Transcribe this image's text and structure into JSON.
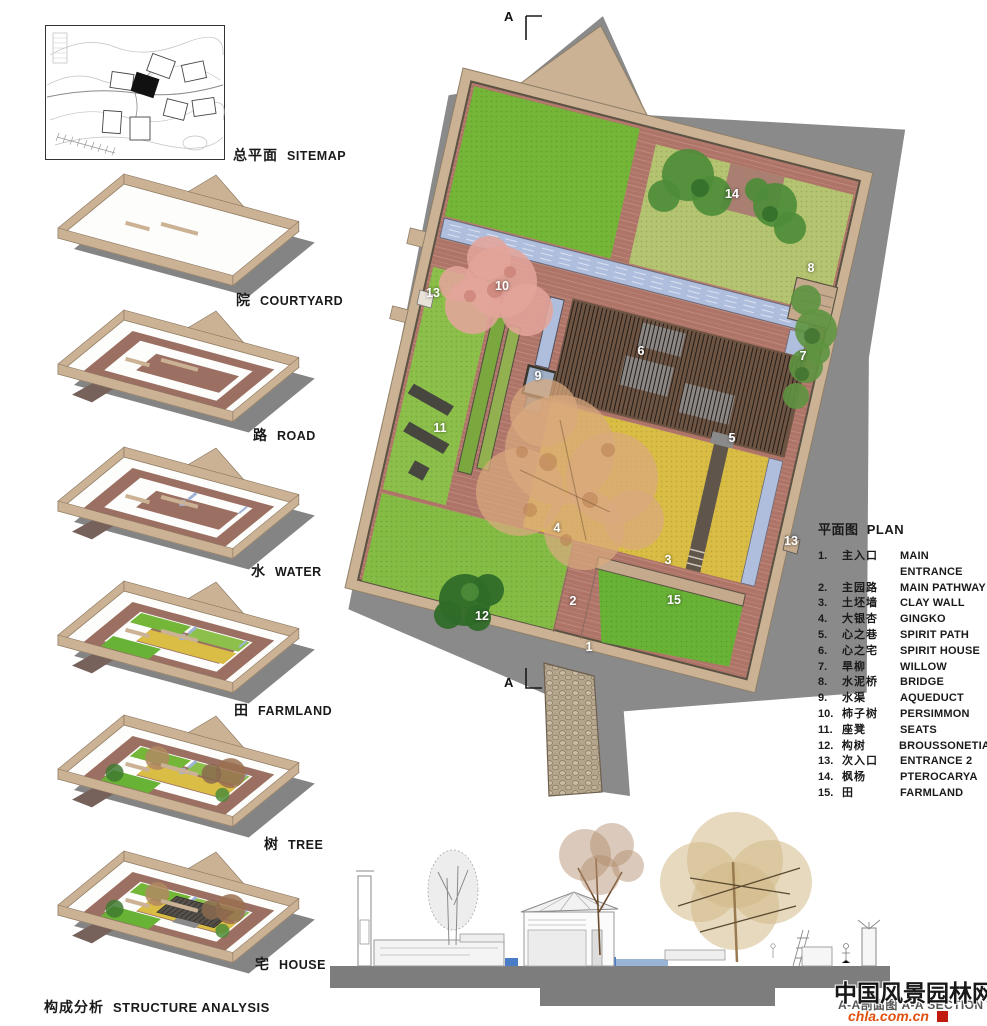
{
  "sitemap": {
    "label_zh": "总平面",
    "label_en": "SITEMAP"
  },
  "stages": [
    {
      "zh": "院",
      "en": "COURTYARD"
    },
    {
      "zh": "路",
      "en": "ROAD"
    },
    {
      "zh": "水",
      "en": "WATER"
    },
    {
      "zh": "田",
      "en": "FARMLAND"
    },
    {
      "zh": "树",
      "en": "TREE"
    },
    {
      "zh": "宅",
      "en": "HOUSE"
    }
  ],
  "analysis": {
    "zh": "构成分析",
    "en": "STRUCTURE ANALYSIS"
  },
  "plan": {
    "title_zh": "平面图",
    "title_en": "PLAN",
    "section_letter": "A",
    "legend": [
      {
        "num": "1.",
        "zh": "主入口",
        "en": "MAIN ENTRANCE"
      },
      {
        "num": "2.",
        "zh": "主园路",
        "en": "MAIN PATHWAY"
      },
      {
        "num": "3.",
        "zh": "土坯墙",
        "en": "CLAY WALL"
      },
      {
        "num": "4.",
        "zh": "大银杏",
        "en": "GINGKO"
      },
      {
        "num": "5.",
        "zh": "心之巷",
        "en": "SPIRIT PATH"
      },
      {
        "num": "6.",
        "zh": "心之宅",
        "en": "SPIRIT HOUSE"
      },
      {
        "num": "7.",
        "zh": "旱柳",
        "en": "WILLOW"
      },
      {
        "num": "8.",
        "zh": "水泥桥",
        "en": "BRIDGE"
      },
      {
        "num": "9.",
        "zh": "水渠",
        "en": "AQUEDUCT"
      },
      {
        "num": "10.",
        "zh": "柿子树",
        "en": "PERSIMMON"
      },
      {
        "num": "11.",
        "zh": "座凳",
        "en": "SEATS"
      },
      {
        "num": "12.",
        "zh": "构树",
        "en": "BROUSSONETIA"
      },
      {
        "num": "13.",
        "zh": "次入口",
        "en": "ENTRANCE 2"
      },
      {
        "num": "14.",
        "zh": "枫杨",
        "en": "PTEROCARYA"
      },
      {
        "num": "15.",
        "zh": "田",
        "en": "FARMLAND"
      }
    ],
    "markers": [
      {
        "n": "1",
        "x": 589,
        "y": 647
      },
      {
        "n": "2",
        "x": 573,
        "y": 601
      },
      {
        "n": "3",
        "x": 668,
        "y": 560
      },
      {
        "n": "4",
        "x": 557,
        "y": 528
      },
      {
        "n": "5",
        "x": 732,
        "y": 438
      },
      {
        "n": "6",
        "x": 641,
        "y": 351
      },
      {
        "n": "7",
        "x": 803,
        "y": 356
      },
      {
        "n": "8",
        "x": 811,
        "y": 268
      },
      {
        "n": "9",
        "x": 538,
        "y": 376
      },
      {
        "n": "10",
        "x": 502,
        "y": 286
      },
      {
        "n": "11",
        "x": 440,
        "y": 428
      },
      {
        "n": "12",
        "x": 482,
        "y": 616
      },
      {
        "n": "13",
        "x": 433,
        "y": 293
      },
      {
        "n": "13",
        "x": 791,
        "y": 541
      },
      {
        "n": "14",
        "x": 732,
        "y": 194
      },
      {
        "n": "15",
        "x": 674,
        "y": 600
      }
    ]
  },
  "section": {
    "label": "A-A剖面图 A-A SECTION"
  },
  "watermark": {
    "name": "中国风景园林网",
    "url": "chla.com.cn"
  },
  "colors": {
    "wall_tan": "#cbb294",
    "wall_dark": "#5a5243",
    "brick": "#ae7468",
    "brick_line": "#bd8a7d",
    "lawn_bright": "#74b637",
    "lawn_light": "#b4c470",
    "lawn_mid": "#8cc04a",
    "field_green": "#68b336",
    "farmland_yellow": "#d9bd44",
    "water_blue": "#b0bedd",
    "water_deep": "#4a7cc8",
    "roof_dark": "#55504a",
    "road_red": "#9b6f62",
    "shadow_gray": "#8a8a8a",
    "tree_pink": "#e2a49a",
    "tree_gingko": "#d9a97e",
    "tree_green": "#4e8c38",
    "watermark_orange": "#e0500e"
  }
}
